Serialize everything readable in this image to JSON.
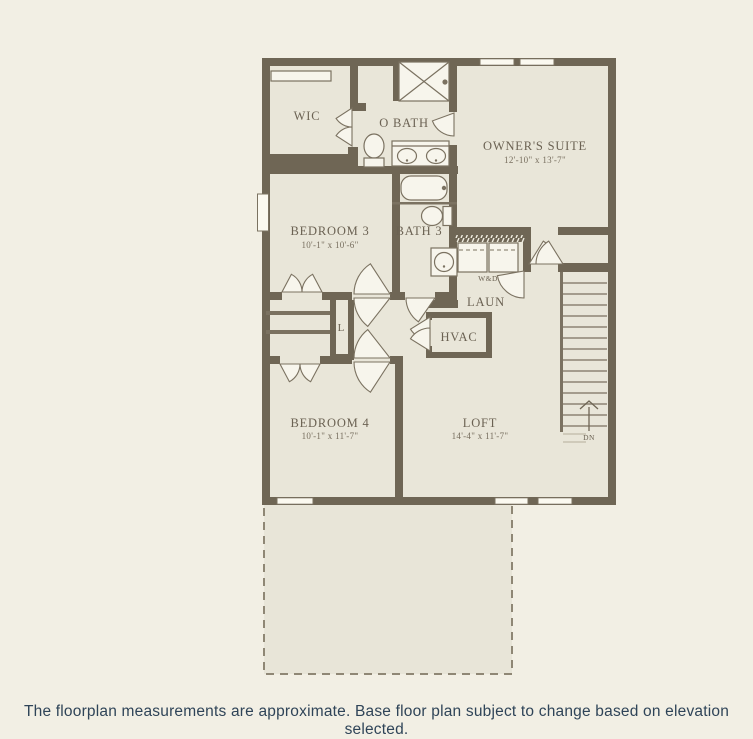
{
  "floorplan": {
    "rooms": {
      "wic": {
        "label": "WIC"
      },
      "owners_bath": {
        "label": "O BATH"
      },
      "owners_suite": {
        "label": "OWNER'S SUITE",
        "dims": "12'-10\" x 13'-7\""
      },
      "bedroom3": {
        "label": "BEDROOM 3",
        "dims": "10'-1\" x 10'-6\""
      },
      "bath3": {
        "label": "BATH 3"
      },
      "laundry": {
        "label": "LAUN",
        "appliance": "W&D"
      },
      "hvac": {
        "label": "HVAC"
      },
      "linen_closet": {
        "label": "L"
      },
      "bedroom4": {
        "label": "BEDROOM 4",
        "dims": "10'-1\" x 11'-7\""
      },
      "loft": {
        "label": "LOFT",
        "dims": "14'-4\" x 11'-7\""
      },
      "stairs": {
        "label": "DN"
      }
    },
    "colors": {
      "background": "#f2efe4",
      "floor": "#e9e6d9",
      "wall": "#6f6655",
      "line": "#7b7261",
      "label_text": "#6b6253",
      "caption_text": "#2f4458"
    }
  },
  "caption": {
    "text": "The floorplan measurements are approximate. Base floor plan subject to change based on elevation selected."
  }
}
